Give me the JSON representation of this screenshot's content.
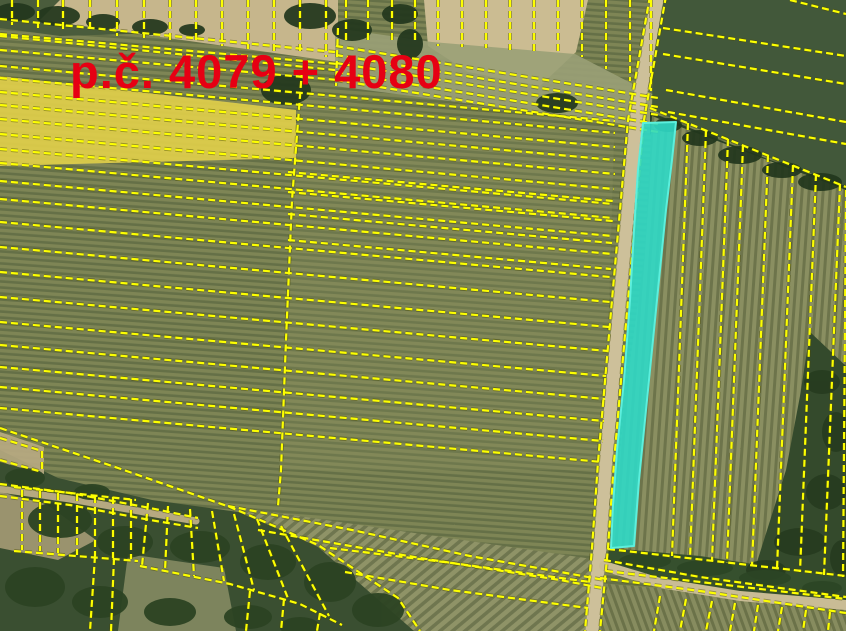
{
  "label": {
    "text": "p.č. 4079 + 4080",
    "color": "#e60013",
    "x": 70,
    "y": 88,
    "font_size": 47
  },
  "palette": {
    "parcel_line_yellow": "#fdff00",
    "parcel_line_casing": "#4c4c00",
    "highlight_cyan_fill": "#2fd9c6",
    "highlight_cyan_edge": "#5cefdd",
    "highlight_yellow_fill": "#ffe800",
    "road_tan": "#cdc09a",
    "field_olive": "#7e8555",
    "field_dark_green": "#42583a",
    "woods_dark": "#3a4f31"
  },
  "highlights": {
    "cyan_parcel": {
      "name": "highlighted-parcel-4079-4080",
      "points": "643,123 676,122 672,160 666,210 660,270 653,340 646,410 639,480 634,546 611,548 613,505 617,450 624,380 630,300 634,230 638,170",
      "fill": "#2fd9c6",
      "stroke": "#5cefdd",
      "opacity": 0.9
    },
    "yellow_strip": {
      "name": "yellow-highlight-strip",
      "points": "0,76 296,110 296,158 0,166",
      "fill": "#ffe800",
      "opacity": 0.4,
      "base_points": "0,76 296,110 296,158 0,166",
      "base_fill": "#cabc85",
      "base_opacity": 0.85
    }
  },
  "geometry": {
    "regions": [
      {
        "name": "grass-top-left",
        "fill": "#4a5c3c",
        "points": "0,0 95,0 200,32 60,36 0,28"
      },
      {
        "name": "field-top-left-tan",
        "fill": "#c6b68c",
        "points": "60,0 338,0 338,62 40,20"
      },
      {
        "name": "field-top-mid-tan",
        "fill": "#cbbc92",
        "points": "424,0 588,0 576,52 540,86 468,72 428,46"
      },
      {
        "name": "field-top-gray-band",
        "fill": "#9aa077",
        "opacity": 0.9,
        "points": "335,28 432,42 575,54 660,98 656,128 335,86"
      },
      {
        "name": "field-middle-tint",
        "fill": "#909466",
        "opacity": 0.22,
        "points": "300,95 614,140 604,470 279,470 287,330 296,160"
      },
      {
        "name": "field-top-right-dark",
        "fill": "#42583a",
        "points": "654,0 846,0 846,186 770,158 652,110"
      },
      {
        "name": "treeline-right",
        "fill": "#2b4126",
        "points": "650,112 770,160 846,186 846,206 768,182 650,134"
      },
      {
        "name": "field-right-strips",
        "fill": "pattern:pat-rows-right",
        "points": "652,116 846,190 846,578 611,551 625,400 645,250"
      },
      {
        "name": "trees-right-edge",
        "fill": "#344a2c",
        "points": "810,332 846,366 846,610 752,578 786,470 800,396"
      },
      {
        "name": "hedge-below-strips",
        "fill": "#36502e",
        "points": "609,548 700,556 846,578 846,602 700,588 606,570"
      },
      {
        "name": "woods-bottom-left",
        "fill": "#3a4f31",
        "points": "0,450 58,478 152,500 238,512 318,546 396,602 418,631 0,631"
      },
      {
        "name": "field-bottom-diag",
        "fill": "pattern:pat-rows-diag",
        "points": "230,506 606,561 598,631 414,631 318,547"
      },
      {
        "name": "field-bottom-right-steep",
        "fill": "pattern:pat-rows-steep",
        "points": "608,584 846,604 846,631 600,631"
      },
      {
        "name": "woods-tan-patch",
        "fill": "#ac9f79",
        "opacity": 0.85,
        "points": "0,492 46,504 96,540 58,560 0,548"
      },
      {
        "name": "woods-light-patch",
        "fill": "#8e9169",
        "opacity": 0.8,
        "points": "128,554 224,568 236,631 118,631"
      },
      {
        "name": "field-left-edge-tan",
        "fill": "#b9ab83",
        "opacity": 0.9,
        "points": "0,432 44,447 44,474 0,462"
      }
    ],
    "roads": [
      {
        "name": "road-main",
        "points": "658,-6 636,120 620,300 606,462 600,548 592,631",
        "width": 13,
        "color": "#cdc09a"
      },
      {
        "name": "road-curve-bottom",
        "points": "604,566 660,583 740,596 846,605",
        "width": 10,
        "color": "#c9bc95"
      },
      {
        "name": "path-bottom-left",
        "points": "0,489 70,499 150,513 196,521",
        "width": 7,
        "color": "#b6a981"
      }
    ],
    "tree_groups": [
      {
        "fill": "#22371d",
        "opacity": 0.92,
        "items": [
          [
            15,
            12,
            20,
            9
          ],
          [
            58,
            16,
            22,
            10
          ],
          [
            103,
            22,
            17,
            8
          ],
          [
            150,
            27,
            18,
            8
          ],
          [
            192,
            30,
            13,
            6
          ],
          [
            310,
            16,
            26,
            13
          ],
          [
            352,
            30,
            20,
            11
          ],
          [
            400,
            14,
            18,
            10
          ],
          [
            410,
            44,
            13,
            15
          ],
          [
            286,
            90,
            25,
            15
          ],
          [
            557,
            103,
            21,
            10
          ],
          [
            668,
            125,
            14,
            7
          ],
          [
            700,
            138,
            18,
            8
          ],
          [
            740,
            155,
            22,
            9
          ],
          [
            782,
            170,
            20,
            8
          ],
          [
            820,
            182,
            22,
            9
          ]
        ]
      },
      {
        "fill": "#2c4323",
        "opacity": 0.95,
        "items": [
          [
            60,
            520,
            32,
            18
          ],
          [
            125,
            542,
            28,
            16
          ],
          [
            200,
            547,
            30,
            16
          ],
          [
            268,
            562,
            28,
            18
          ],
          [
            330,
            582,
            26,
            20
          ],
          [
            378,
            610,
            26,
            17
          ],
          [
            35,
            587,
            30,
            20
          ],
          [
            100,
            602,
            28,
            16
          ],
          [
            170,
            612,
            26,
            14
          ],
          [
            248,
            617,
            24,
            12
          ],
          [
            25,
            478,
            20,
            10
          ],
          [
            92,
            492,
            18,
            8
          ],
          [
            300,
            627,
            20,
            10
          ]
        ]
      },
      {
        "fill": "#273c20",
        "opacity": 0.95,
        "items": [
          [
            822,
            382,
            18,
            12
          ],
          [
            836,
            432,
            14,
            20
          ],
          [
            826,
            492,
            20,
            18
          ],
          [
            800,
            542,
            26,
            14
          ],
          [
            842,
            558,
            12,
            18
          ],
          [
            766,
            570,
            20,
            10
          ]
        ]
      },
      {
        "fill": "#2c4525",
        "opacity": 0.9,
        "items": [
          [
            645,
            561,
            26,
            8
          ],
          [
            705,
            568,
            28,
            8
          ],
          [
            765,
            578,
            26,
            8
          ],
          [
            822,
            588,
            20,
            7
          ]
        ]
      }
    ],
    "parcel_lines": [
      "0,19 335,52",
      "0,36 335,70",
      "0,34 338,64",
      "0,50 338,80",
      "0,66 615,121",
      "0,78 615,133",
      "0,92 615,147",
      "0,105 615,160",
      "0,119 615,174",
      "0,134 614,189",
      "0,149 613,204",
      "0,163 613,218",
      "0,181 612,236",
      "0,199 612,254",
      "0,222 610,277",
      "0,247 610,302",
      "0,272 609,327",
      "0,297 608,351",
      "0,322 606,376",
      "0,345 605,399",
      "0,367 604,421",
      "0,387 603,441",
      "0,408 602,462",
      "0,428 118,468 230,507 318,545 398,598 420,631",
      "228,506 352,530 470,556 566,573 604,580",
      "258,530 420,558 560,580 602,588",
      "288,172 613,201",
      "288,192 613,221",
      "288,214 612,243",
      "288,240 611,269",
      "302,70 292,200 286,340 281,470 278,506",
      "338,28 336,86",
      "12,0 12,25",
      "38,0 38,28",
      "63,0 63,30",
      "90,0 90,33",
      "117,0 117,36",
      "144,0 144,38",
      "170,0 170,41",
      "196,0 196,44",
      "222,0 222,46",
      "248,0 248,49",
      "274,0 274,51",
      "300,0 300,54",
      "326,0 326,57",
      "346,0 346,40",
      "368,0 368,42",
      "392,0 392,43",
      "415,0 415,44",
      "438,0 438,46",
      "462,0 462,47",
      "486,0 486,48",
      "510,0 510,50",
      "534,0 534,51",
      "558,0 558,52",
      "582,0 582,57",
      "606,0 606,69",
      "630,0 630,81",
      "651,0 651,91",
      "336,46 658,98",
      "336,55 658,107",
      "336,63 658,115",
      "336,72 658,124",
      "336,80 658,132",
      "650,-4 628,120 612,300 598,462 592,548 585,631",
      "666,-4 644,120 628,300 614,462 608,548 600,631",
      "790,0 846,14",
      "663,28 846,56",
      "663,54 846,84",
      "666,90 846,122",
      "668,112 846,144",
      "650,108 846,187",
      "688,123 672,556",
      "706,130 690,559",
      "728,139 712,561",
      "743,145 727,563",
      "768,155 752,566",
      "793,165 777,569",
      "816,174 800,572",
      "840,184 824,575",
      "846,190 843,577",
      "608,549 846,576",
      "606,571 846,599",
      "604,560 700,577 846,597",
      "600,578 700,591 846,613",
      "660,596 654,631",
      "686,599 680,631",
      "712,601 706,631",
      "735,603 730,631",
      "758,605 754,631",
      "782,607 778,631",
      "806,610 803,631",
      "830,612 828,631",
      "330,548 452,563 590,582",
      "345,572 450,590 588,608",
      "14,487 136,500",
      "14,551 138,561",
      "22,490 22,550",
      "40,491 40,551",
      "58,493 58,553",
      "77,494 77,555",
      "95,496 95,556",
      "113,497 113,558",
      "131,499 131,559",
      "0,484 70,493 150,508 198,518",
      "0,496 70,505 150,520 198,528",
      "148,503 142,566",
      "168,506 165,571",
      "190,509 194,576",
      "212,511 224,581",
      "234,514 254,590",
      "257,519 289,601",
      "281,526 329,616",
      "140,566 230,584 300,604 342,625",
      "95,556 90,631",
      "114,558 111,631",
      "250,591 246,631",
      "284,599 281,631",
      "320,613 317,631",
      "0,438 42,451",
      "0,460 42,472",
      "42,451 42,473"
    ]
  }
}
